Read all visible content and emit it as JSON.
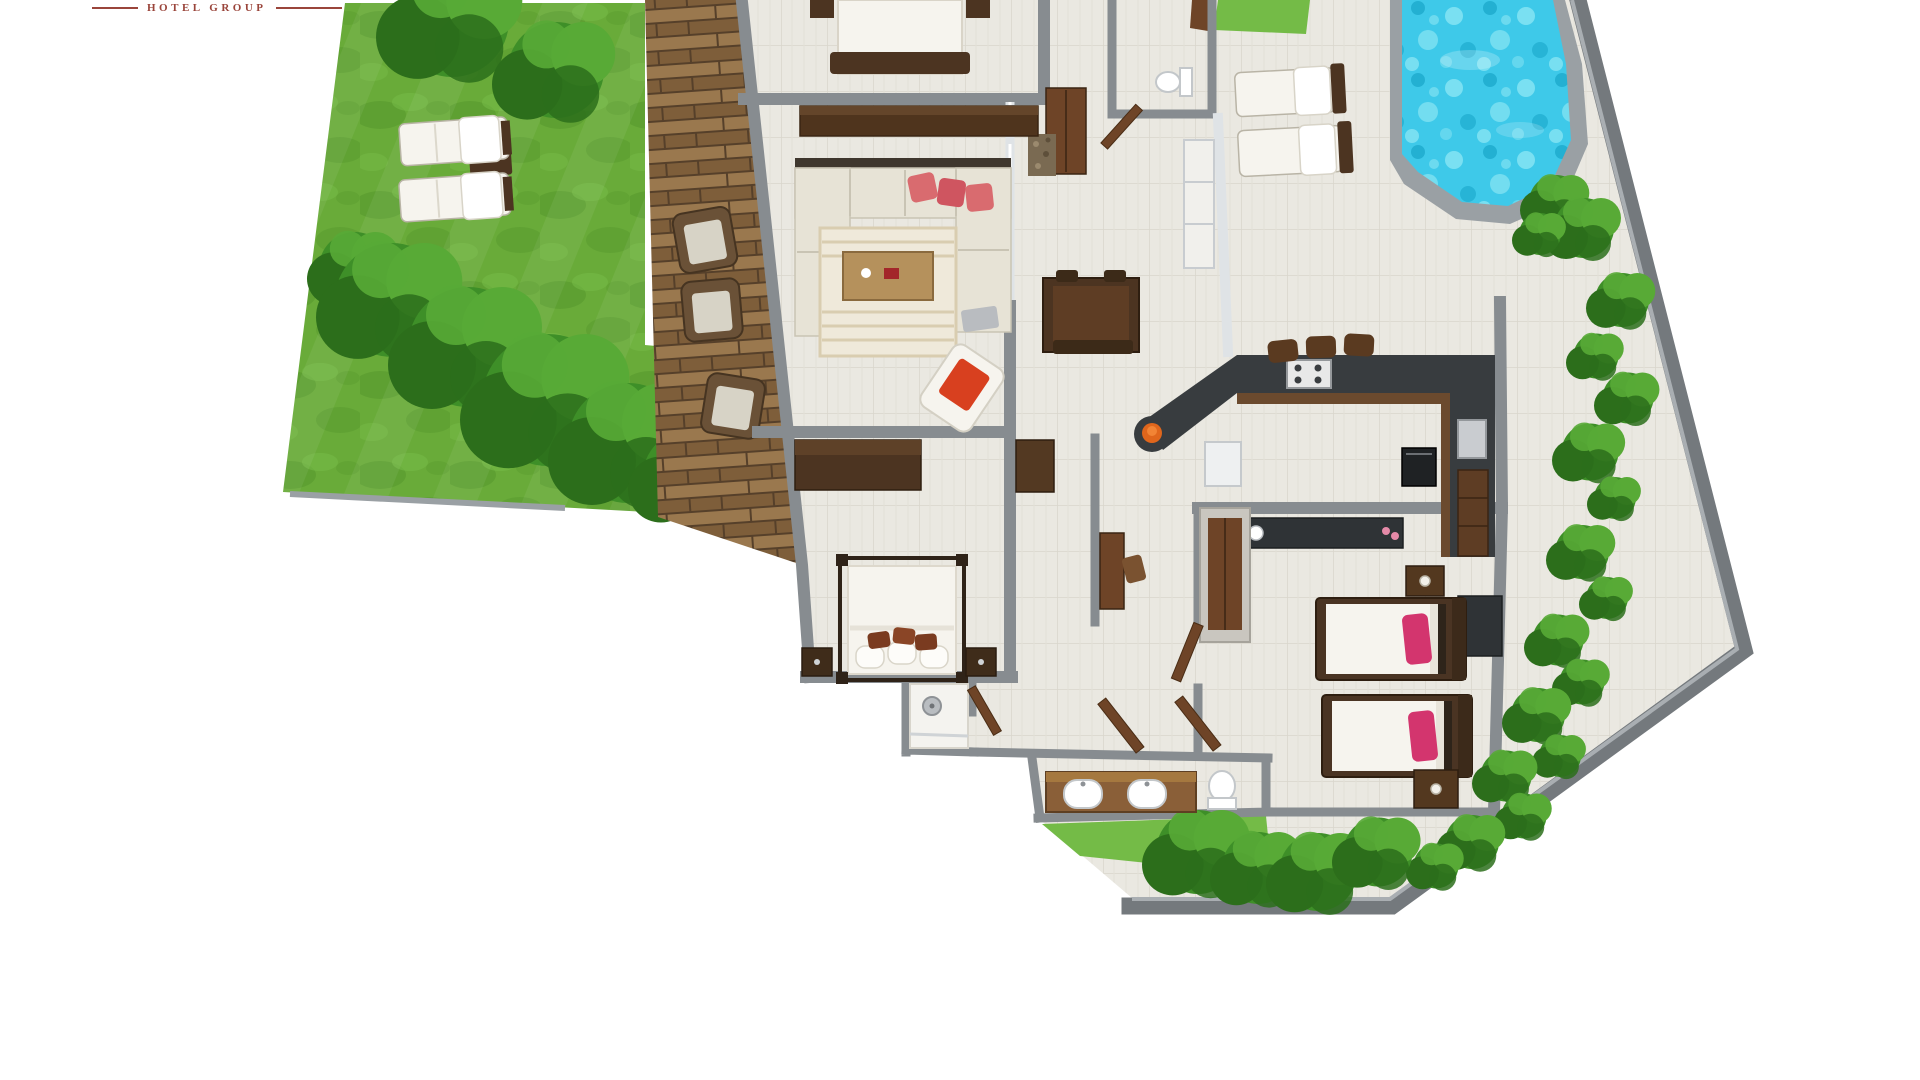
{
  "logo": {
    "text": "HOTEL GROUP"
  },
  "scene": {
    "description": "3D top-down rendered floor plan of a villa: garden lawn with trees and sun loungers on the left, wooden deck, open-plan living/dining/kitchen, master bedroom with four-poster bed, twin bedroom with pink pillows, bathrooms, paved pool terrace with swimming pool at top right, perimeter wall with shrubs",
    "areas": [
      "garden-lawn",
      "wood-deck",
      "living-room",
      "dining-area",
      "kitchen",
      "hallway",
      "master-bedroom",
      "shower-room",
      "bathroom",
      "twin-bedroom",
      "guest-bedroom-cropped",
      "wc",
      "pool-terrace",
      "swimming-pool",
      "perimeter-planting"
    ],
    "furniture": [
      "2 garden sun loungers with side table",
      "3 deck wicker armchairs",
      "U-shaped cream sofa with 3 coral pillows",
      "striped area rug",
      "wood coffee table",
      "armchair with red cushion",
      "dark wood dining table with bench",
      "long sideboard",
      "TV console",
      "four-poster double bed",
      "2 master nightstands",
      "corner shower",
      "double vanity with 2 sinks",
      "2 toilets",
      "U-shaped dark kitchen counter",
      "3 bar stools",
      "cooktop",
      "oven",
      "orange fruit bowl",
      "tall kitchen cabinet",
      "wardrobe with wood doors",
      "minibar counter with kettle and cups",
      "2 twin single beds with pink pillows",
      "2 twin nightstands with lamps",
      "desk with chair",
      "2 pool sun loungers"
    ]
  },
  "palette": {
    "page_bg": "#ffffff",
    "logo": "#9a453b",
    "lawn_base": "#69ab39",
    "lawn_dark": "#55962c",
    "lawn_light": "#78bd49",
    "grass_patch": "#74bb47",
    "fol_dark": "#2c6e1b",
    "fol_mid": "#3e8f28",
    "fol_light": "#58aa36",
    "deck_base": "#8f6e46",
    "deck_light": "#9a784e",
    "deck_dark": "#7e5e3a",
    "deck_gap": "#56402a",
    "tile_base": "#eae8e1",
    "tile_line": "#d9d6cc",
    "tile_line2": "#e2dfd7",
    "wall": "#878c90",
    "wall_dark": "#74797d",
    "wall_light": "#a9aeb2",
    "glass": "#dfe3e6",
    "water": "#3ec9e9",
    "water_light": "#8ae6f4",
    "water_dark": "#18a6c9",
    "pool_edge": "#9aa0a4",
    "sofa": "#e7e3d6",
    "sofa_dark": "#3f372e",
    "pillow": "#d96b6f",
    "rug": "#efe9da",
    "rug_stripe": "#d9cdb0",
    "wood_dark": "#4c3421",
    "wood_mid": "#6e4427",
    "wood_light": "#b5915c",
    "counter": "#383c3f",
    "white_furn": "#f6f4ee",
    "pink": "#d3356e",
    "orange": "#e0661c",
    "red": "#d8401f",
    "steel": "#c9ccd0",
    "vanity": "#8a5f38"
  }
}
